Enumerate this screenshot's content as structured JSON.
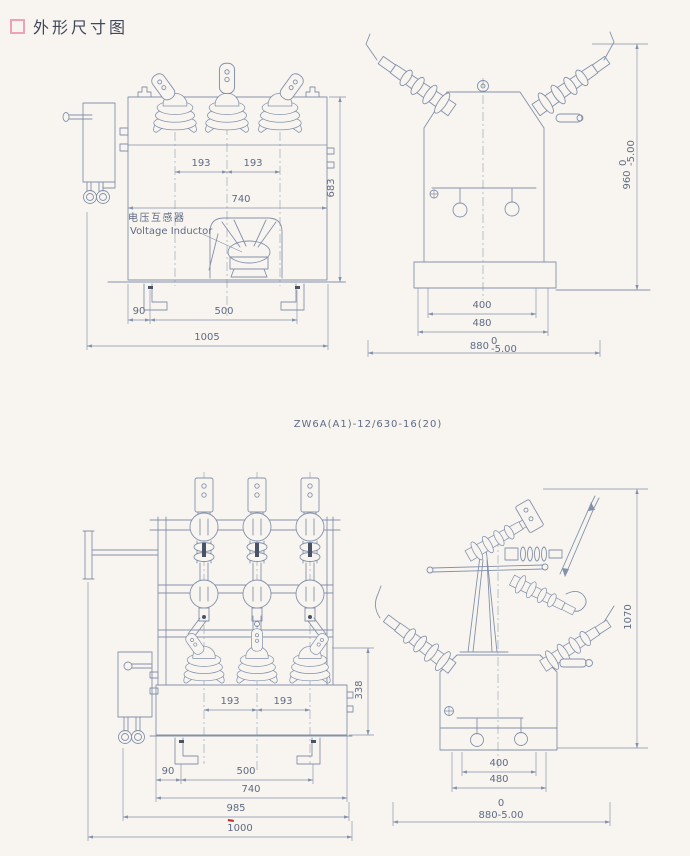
{
  "page": {
    "title": "外形尺寸图",
    "model_label": "ZW6A(A1)-12/630-16(20)"
  },
  "labels": {
    "voltage_inductor_cn": "电压互感器",
    "voltage_inductor_en": "Voltage Inductor"
  },
  "colors": {
    "paper": "#f8f5f0",
    "line": "#8391ab",
    "text": "#5f6b85",
    "title_text": "#40475a",
    "bullet_pink": "#eda3b2",
    "red_mark": "#c03030"
  },
  "views": {
    "top_front": {
      "dims": {
        "phase_spacing_1": "193",
        "phase_spacing_2": "193",
        "tank_width": "740",
        "height": "683",
        "foot_offset": "90",
        "foot_spacing": "500",
        "overall_width": "1005"
      }
    },
    "top_side": {
      "dims": {
        "base_hole_spacing": "400",
        "base_width": "480",
        "depth": "880",
        "depth_tol_upper": "0",
        "depth_tol_lower": "-5.00",
        "overall_height": "960",
        "height_tol_upper": "0",
        "height_tol_lower": "-5.00"
      }
    },
    "bottom_front": {
      "dims": {
        "phase_spacing_1": "193",
        "phase_spacing_2": "193",
        "bushing_height": "338",
        "foot_offset": "90",
        "foot_spacing": "500",
        "tank_width": "740",
        "frame_width": "985",
        "overall_width": "1000"
      }
    },
    "bottom_side": {
      "dims": {
        "base_hole_spacing": "400",
        "base_width": "480",
        "depth_tol_upper": "0",
        "depth": "880-5.00",
        "overall_height": "1070"
      }
    }
  }
}
